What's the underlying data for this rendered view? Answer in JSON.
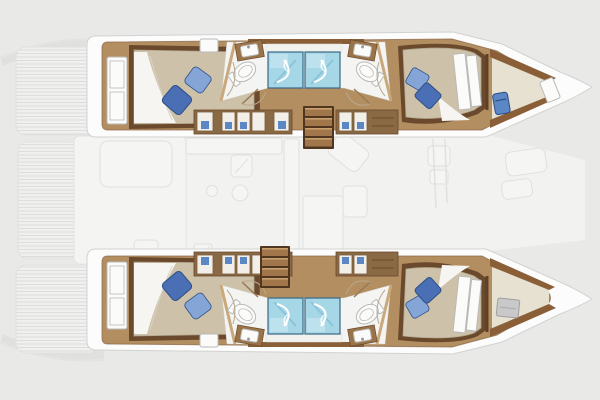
{
  "app": {
    "type": "floorplan-diagram",
    "subject": "Catamaran yacht interior layout plan - 4 double cabins, 4 bathrooms, central salon"
  },
  "colors": {
    "bg": "#e9e9e8",
    "salonBg": "#f3f3f2",
    "faintFill": "#f7f7f6",
    "faintLine": "#e0e0df",
    "deckLine": "#dcdcdb",
    "deckFill": "#f1f1f0",
    "hullBand": "#fcfcfc",
    "hullEdge": "#d2d2d0",
    "wood": "#b28e61",
    "woodLight": "#c9a06d",
    "woodEdge": "#8a6444",
    "trimDark": "#6a492c",
    "trimMid": "#c9a97c",
    "wallBrown": "#8a5f38",
    "stepTread": "#a0764a",
    "stepGap": "#50361f",
    "mattress": "#cdc1a9",
    "mattressEdge": "#b2a68c",
    "sheet": "#f7f5f1",
    "sheetLine": "#d8d2c6",
    "pillowDark": "#4a6fb4",
    "pillowLight": "#84a5d6",
    "pillowEdge": "#2d4e86",
    "shower": "#a6d7e7",
    "showerLight": "#cfeaf2",
    "showerStreak": "#86bed4",
    "showerEdge": "#3a6886",
    "tray": "#f1f1ee",
    "bathFloor": "#f4f4f2",
    "fixture": "#fbfbfa",
    "fixtureLine": "#b9b9b9",
    "vanity": "#9a7448",
    "lockerBase": "#8a6a45",
    "lockerPanel": "#f2efe9",
    "lockerFrame": "#7a5a38",
    "lockerBlue": "#5b87c5",
    "hatchGray": "#c9c9c9",
    "forepeak": "#e7e1d2",
    "seatBlue": "#5b87c5",
    "doorArc": "#b9a88e",
    "doorLeaf": "#9a7a54"
  },
  "layout": {
    "orientation": "bow-right",
    "hulls": [
      {
        "id": "port",
        "position": "top",
        "rooms": [
          "aft-double-cabin",
          "aft-bathroom",
          "forward-bathroom",
          "corridor-wardrobes",
          "forward-double-cabin",
          "forepeak"
        ]
      },
      {
        "id": "starboard",
        "position": "bottom",
        "rooms": [
          "aft-double-cabin",
          "aft-bathroom",
          "forward-bathroom",
          "corridor-wardrobes",
          "forward-double-cabin",
          "forepeak"
        ]
      }
    ],
    "center": {
      "rooms": [
        "aft-deck",
        "cockpit",
        "galley",
        "salon-dining",
        "foredeck"
      ],
      "companionway_stairs": 2
    },
    "counts": {
      "double_beds": 4,
      "showers": 4,
      "toilets": 4,
      "sinks": 4,
      "pillows_per_bed": 2
    }
  }
}
